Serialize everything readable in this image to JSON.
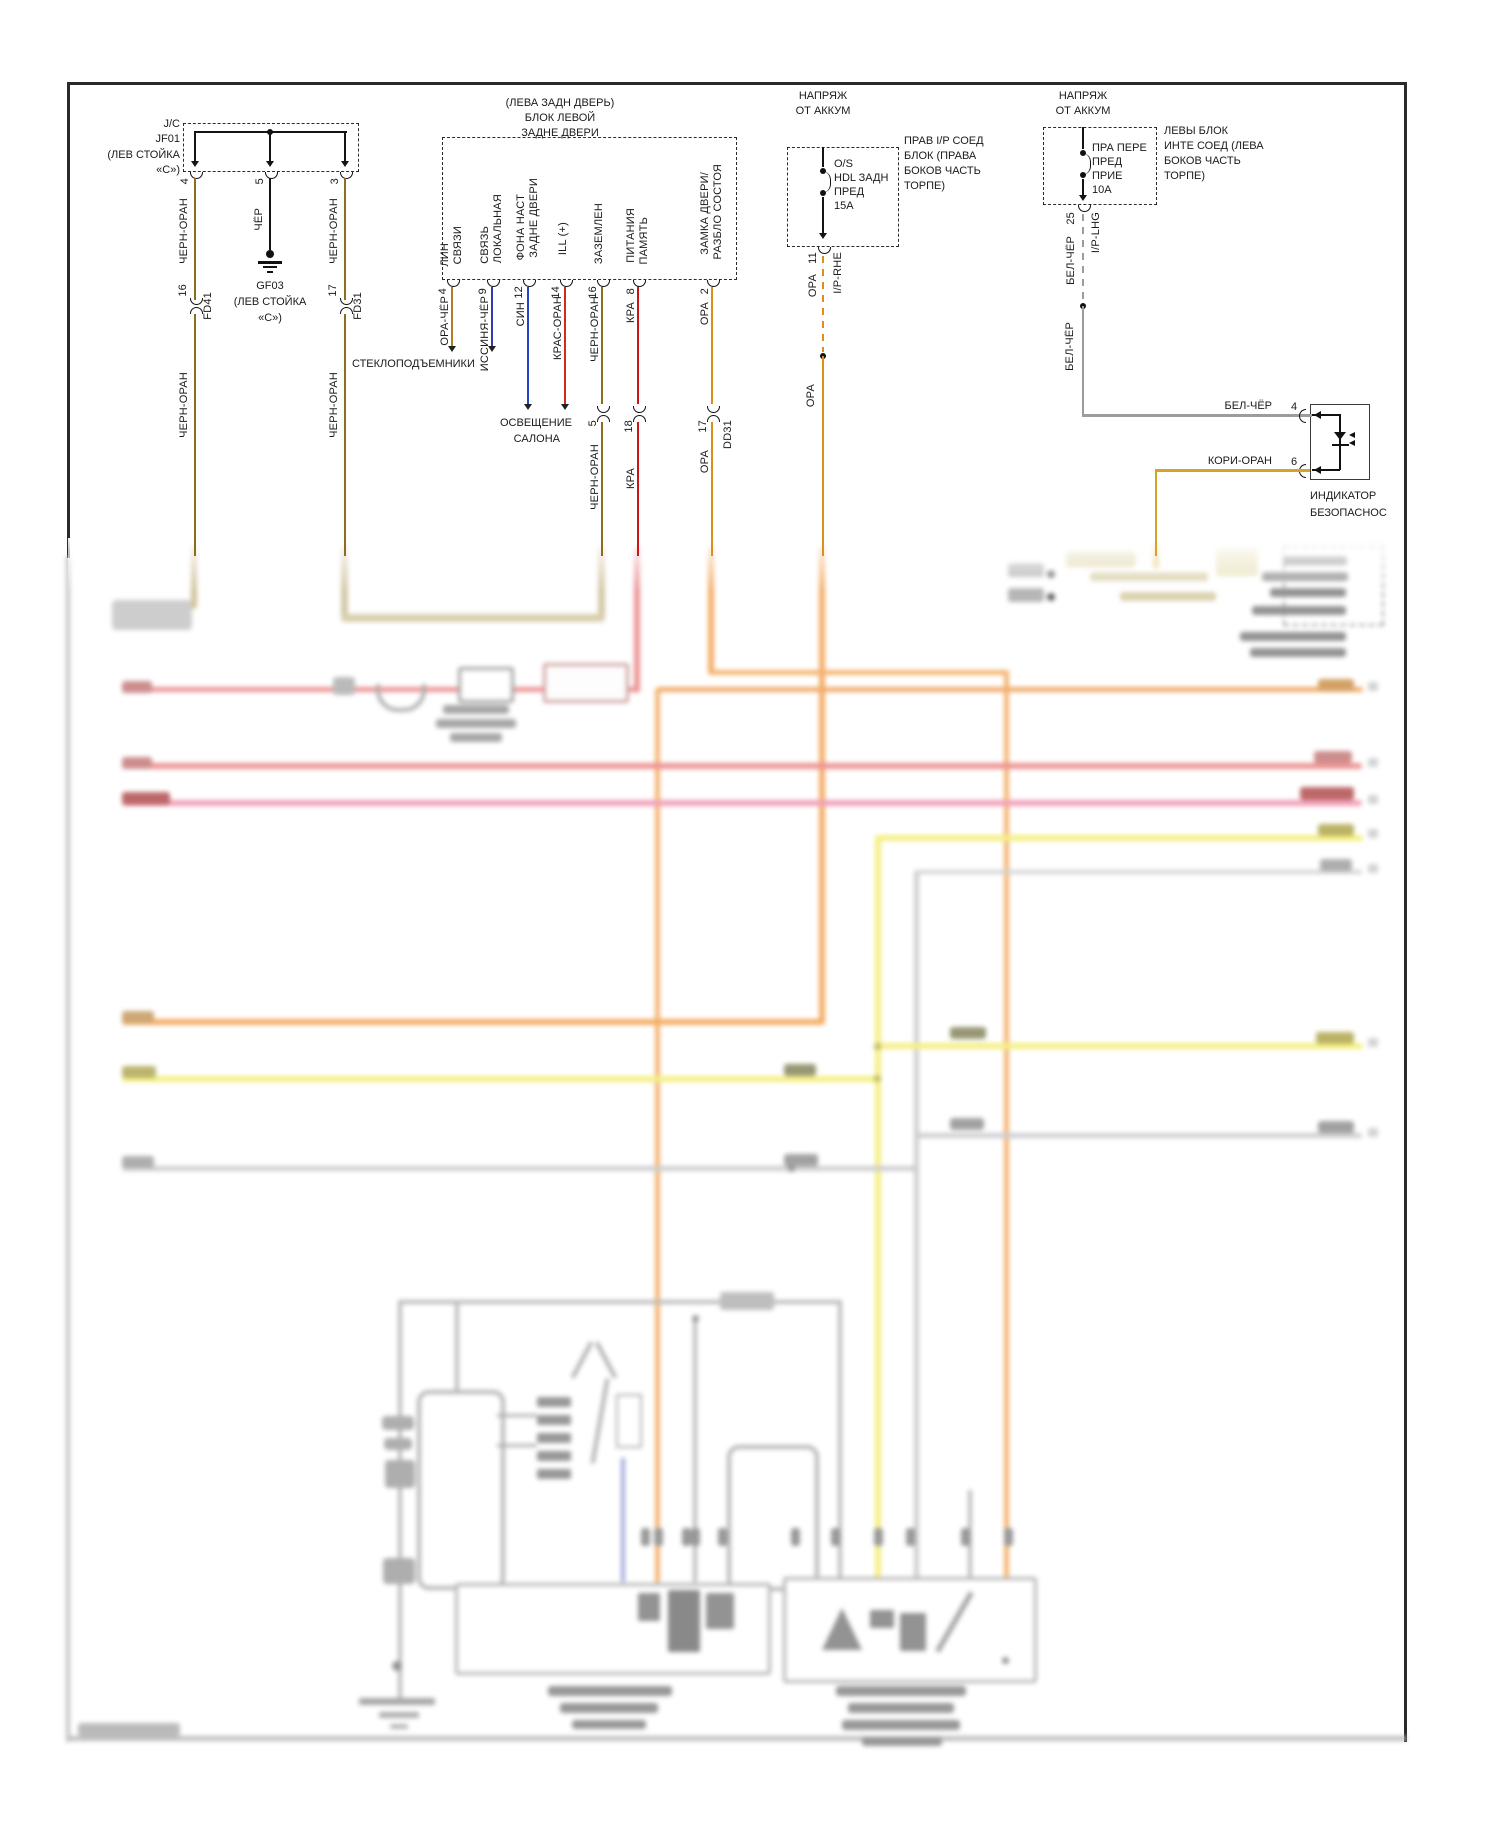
{
  "title": "wiring-diagram-door-lock",
  "jc": {
    "l1": "J/C",
    "l2": "JF01",
    "l3": "(ЛЕВ СТОЙКА",
    "l4": "«С»)",
    "p1": "4",
    "p2": "5",
    "p3": "3",
    "w1": "ЧЕРН-ОРАН",
    "w2": "ЧЁР",
    "w3": "ЧЕРН-ОРАН",
    "w1b": "ЧЕРН-ОРАН",
    "w3b": "ЧЕРН-ОРАН"
  },
  "gnd": {
    "name": "GF03",
    "l1": "(ЛЕВ СТОЙКА",
    "l2": "«С»)"
  },
  "fd41": {
    "pin": "16",
    "name": "FD41"
  },
  "fd31": {
    "pin": "17",
    "name": "FD31"
  },
  "door": {
    "t1": "(ЛЕВА ЗАДН ДВЕРЬ)",
    "t2": "БЛОК ЛЕВОЙ",
    "t3": "ЗАДНЕ ДВЕРИ",
    "f1a": "ЛИН",
    "f1b": "СВЯЗИ",
    "f2a": "СВЯЗЬ",
    "f2b": "ЛОКАЛЬНАЯ",
    "f3a": "ФОНА НАСТ",
    "f3b": "ЗАДНЕ ДВЕРИ",
    "f4": "ILL (+)",
    "f5": "ЗАЗЕМЛЕН",
    "f6a": "ПИТАНИЯ",
    "f6b": "ПАМЯТЬ",
    "f7a": "ЗАМКА ДВЕРИ/",
    "f7b": "РАЗБЛО СОСТОЯ",
    "p1": "4",
    "p2": "9",
    "p3": "12",
    "p4": "14",
    "p5": "16",
    "p6": "8",
    "p7": "2",
    "w1": "ОРА-ЧЁР",
    "w2": "ИССИНЯ-ЧЁР",
    "w3": "СИН",
    "w4": "КРАС-ОРАН",
    "w5": "ЧЕРН-ОРАН",
    "w6": "КРА",
    "w7": "ОРА"
  },
  "dest": {
    "a": "СТЕКЛОПОДЪЕМНИКИ",
    "b1": "ОСВЕЩЕНИЕ",
    "b2": "САЛОНА"
  },
  "row2": {
    "p5": "5",
    "w5": "ЧЕРН-ОРАН",
    "p6": "18",
    "w6": "КРА",
    "p7": "17",
    "w7": "ОРА",
    "conn": "DD31"
  },
  "fuse1": {
    "t1": "НАПРЯЖ",
    "t2": "ОТ АККУМ",
    "a": "O/S",
    "b": "HDL ЗАДН",
    "c": "ПРЕД",
    "d": "15A",
    "r1": "ПРАВ I/P СОЕД",
    "r2": "БЛОК (ПРАВА",
    "r3": "БОКОВ ЧАСТЬ",
    "r4": "ТОРПЕ)",
    "pin": "11",
    "w": "ОРА",
    "conn": "I/P-RHE",
    "w2": "ОРА"
  },
  "fuse2": {
    "t1": "НАПРЯЖ",
    "t2": "ОТ АККУМ",
    "a": "ПРА ПЕРЕ",
    "b": "ПРЕД",
    "c": "ПРИЕ",
    "d": "10A",
    "r1": "ЛЕВЫ БЛОК",
    "r2": "ИНТЕ СОЕД (ЛЕВА",
    "r3": "БОКОВ ЧАСТЬ",
    "r4": "ТОРПЕ)",
    "pin": "25",
    "w": "БЕЛ-ЧЁР",
    "conn": "I/P-LHG",
    "w2": "БЕЛ-ЧЁР"
  },
  "ind": {
    "wt": "БЕЛ-ЧЁР",
    "pt": "4",
    "wb": "КОРИ-ОРАН",
    "pb": "6",
    "n1": "ИНДИКАТОР",
    "n2": "БЕЗОПАСНОС"
  },
  "icons": [
    "ground-symbol",
    "fuse-symbol",
    "junction-dot",
    "connector-bracket",
    "led-indicator-symbol",
    "arrow-down"
  ],
  "colors": {
    "chern_oran": "#8c6d1f",
    "cher": "#141414",
    "ora_cher": "#b07c28",
    "issinya_cher": "#2f3fae",
    "sin": "#2244cc",
    "kras_oran": "#c8301c",
    "kra": "#cc1414",
    "ora": "#dd8f1c",
    "bel_cher": "#9c9c9c",
    "kori_oran": "#d7a326",
    "frame": "#2a2a2a"
  }
}
